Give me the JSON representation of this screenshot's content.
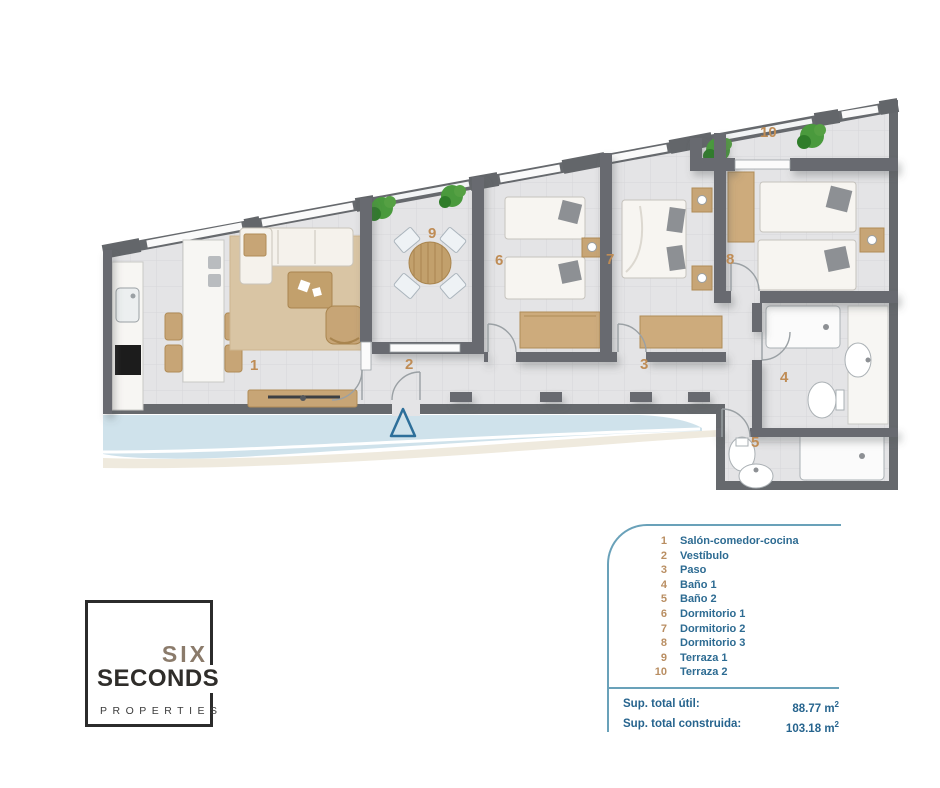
{
  "plan": {
    "room_labels": [
      "1",
      "2",
      "3",
      "4",
      "5",
      "6",
      "7",
      "8",
      "9",
      "10"
    ],
    "colors": {
      "wall": "#66696d",
      "floor": "#e4e4e6",
      "rug": "#d9c5a4",
      "wood": "#c7a576",
      "water_band": "#cfe2eb",
      "marker_blue": "#2d6f9a"
    }
  },
  "legend": {
    "items": [
      {
        "num": "1",
        "label": "Salón-comedor-cocina"
      },
      {
        "num": "2",
        "label": "Vestíbulo"
      },
      {
        "num": "3",
        "label": "Paso"
      },
      {
        "num": "4",
        "label": "Baño 1"
      },
      {
        "num": "5",
        "label": "Baño 2"
      },
      {
        "num": "6",
        "label": "Dormitorio 1"
      },
      {
        "num": "7",
        "label": "Dormitorio 2"
      },
      {
        "num": "8",
        "label": "Dormitorio 3"
      },
      {
        "num": "9",
        "label": "Terraza 1"
      },
      {
        "num": "10",
        "label": "Terraza 2"
      }
    ],
    "totals": [
      {
        "label": "Sup. total útil:",
        "value": "88.77",
        "unit": "m",
        "sup": "2"
      },
      {
        "label": "Sup. total construida:",
        "value": "103.18",
        "unit": "m",
        "sup": "2"
      }
    ]
  },
  "logo": {
    "top": "SIX",
    "middle": "SECONDS",
    "bottom": "PROPERTIES"
  }
}
